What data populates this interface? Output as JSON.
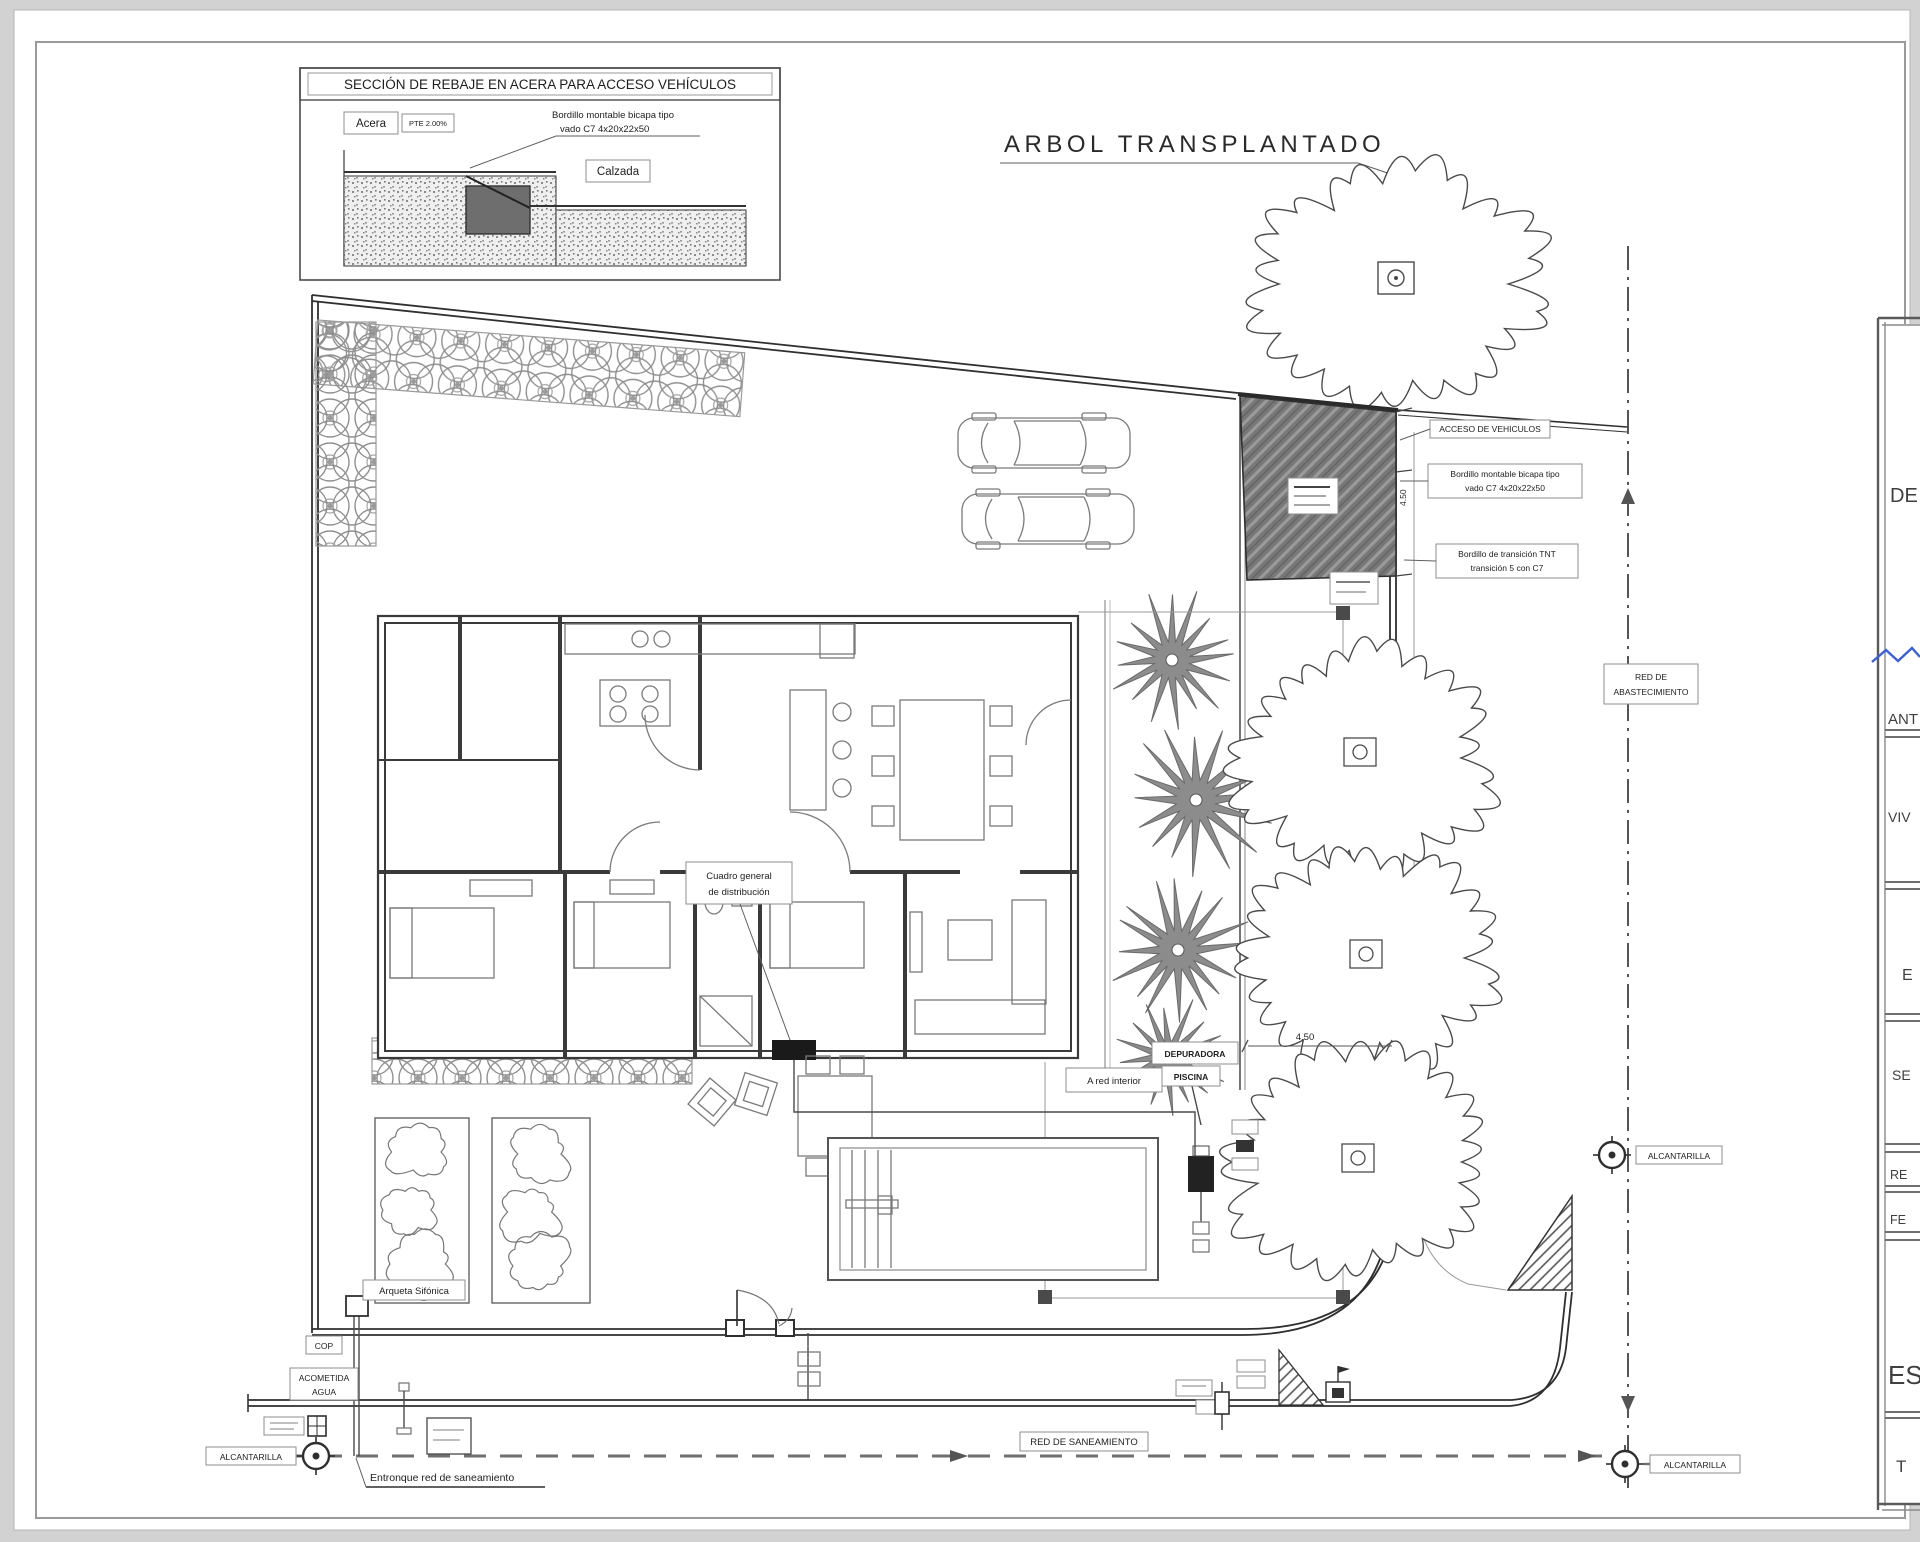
{
  "detail_box": {
    "title": "SECCIÓN DE REBAJE EN ACERA PARA ACCESO VEHÍCULOS",
    "acera": "Acera",
    "pte": "PTE 2.00%",
    "bordillo_l1": "Bordillo montable bicapa tipo",
    "bordillo_l2": "vado C7 4x20x22x50",
    "calzada": "Calzada"
  },
  "titles": {
    "arbol": "ARBOL TRANSPLANTADO"
  },
  "driveway": {
    "acceso": "ACCESO DE VEHICULOS",
    "bordillo1_l1": "Bordillo montable bicapa tipo",
    "bordillo1_l2": "vado C7 4x20x22x50",
    "bordillo2_l1": "Bordillo de transición TNT",
    "bordillo2_l2": "transición 5 con C7",
    "dim_lateral": "4.50"
  },
  "house": {
    "cuadro_l1": "Cuadro general",
    "cuadro_l2": "de distribución"
  },
  "pool": {
    "a_red_interior": "A red interior",
    "depuradora": "DEPURADORA",
    "piscina": "PISCINA",
    "dim": "4.50"
  },
  "utilities": {
    "arqueta_sifonica": "Arqueta Sifónica",
    "cop": "COP",
    "acometida_l1": "ACOMETIDA",
    "acometida_l2": "AGUA",
    "alcantarilla_left": "ALCANTARILLA",
    "entronque": "Entronque red de saneamiento",
    "red_saneamiento": "RED DE SANEAMIENTO",
    "red_abastecimiento_l1": "RED DE",
    "red_abastecimiento_l2": "ABASTECIMIENTO",
    "alcantarilla_mid": "ALCANTARILLA",
    "alcantarilla_bottom": "ALCANTARILLA"
  },
  "title_block": {
    "rows": [
      "DE",
      "ANT",
      "VIV",
      "E",
      "SE",
      "RE",
      "FE",
      "ES",
      "T"
    ]
  },
  "colors": {
    "accent_blue": "#3b5fd9",
    "driveway_fill": "#787878",
    "line": "#3a3a3a"
  }
}
